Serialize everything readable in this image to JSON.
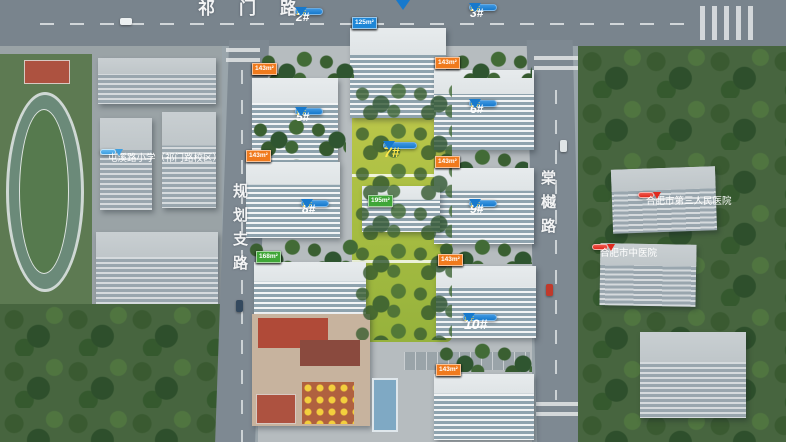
{
  "colors": {
    "pin-blue": "#1779cc",
    "tag-blue": "#1e86d6",
    "tag-orange": "#f07a1d",
    "tag-green": "#3fa637",
    "bubble-red": "#e02a1e",
    "bubble-blue": "#3f9fe0",
    "pin-sub-yellow": "#ffd94d"
  },
  "roads": {
    "top": "祁门路",
    "left": "规划支路",
    "right": "棠樾路"
  },
  "poi": {
    "school": "屯溪路小学（祁门路校区）",
    "hospital_third": "合肥市第三人民医院",
    "hospital_tcm": "合肥市中医院"
  },
  "pins": {
    "p2": {
      "num": "2#",
      "floors": "17F"
    },
    "p3": {
      "num": "3#",
      "floors": "18F"
    },
    "p5": {
      "num": "5#",
      "floors": "17F"
    },
    "p6": {
      "num": "6#",
      "floors": "15F"
    },
    "p7": {
      "num": "7#",
      "floors": "2F"
    },
    "p8": {
      "num": "8#",
      "floors": "10F"
    },
    "p9": {
      "num": "9#",
      "floors": "17F"
    },
    "p10": {
      "num": "10#",
      "floors": "10F"
    }
  },
  "areas": {
    "top_row": [
      {
        "t": "125m²",
        "c": "blue"
      },
      {
        "t": "165m²",
        "c": "green"
      },
      {
        "t": "195m²",
        "c": "green"
      },
      {
        "t": "125m²",
        "c": "blue"
      }
    ],
    "b2": [
      {
        "t": "153m²",
        "c": "orange"
      },
      {
        "t": "125m²",
        "c": "blue"
      },
      {
        "t": "128m²",
        "c": "blue"
      },
      {
        "t": "143m²",
        "c": "orange"
      }
    ],
    "b3": [
      {
        "t": "143m²",
        "c": "orange"
      },
      {
        "t": "125m²",
        "c": "blue"
      },
      {
        "t": "125m²",
        "c": "blue"
      },
      {
        "t": "143m²",
        "c": "orange"
      }
    ],
    "b5": [
      {
        "t": "143m²",
        "c": "orange"
      },
      {
        "t": "125m²",
        "c": "blue"
      },
      {
        "t": "125m²",
        "c": "blue"
      },
      {
        "t": "143m²",
        "c": "orange"
      }
    ],
    "b6": [
      {
        "t": "143m²",
        "c": "orange"
      },
      {
        "t": "125m²",
        "c": "blue"
      },
      {
        "t": "125m²",
        "c": "blue"
      },
      {
        "t": "143m²",
        "c": "orange"
      }
    ],
    "b7": [
      {
        "t": "165m²",
        "c": "green"
      },
      {
        "t": "195m²",
        "c": "green"
      }
    ],
    "b8": [
      {
        "t": "168m²",
        "c": "green"
      },
      {
        "t": "168m²",
        "c": "green"
      },
      {
        "t": "168m²",
        "c": "green"
      },
      {
        "t": "168m²",
        "c": "green"
      }
    ],
    "b9": [
      {
        "t": "143m²",
        "c": "orange"
      },
      {
        "t": "125m²",
        "c": "blue"
      },
      {
        "t": "125m²",
        "c": "blue"
      },
      {
        "t": "143m²",
        "c": "orange"
      }
    ],
    "b10": [
      {
        "t": "143m²",
        "c": "orange"
      },
      {
        "t": "143m²",
        "c": "orange"
      },
      {
        "t": "143m²",
        "c": "orange"
      },
      {
        "t": "143m²",
        "c": "orange"
      }
    ]
  }
}
